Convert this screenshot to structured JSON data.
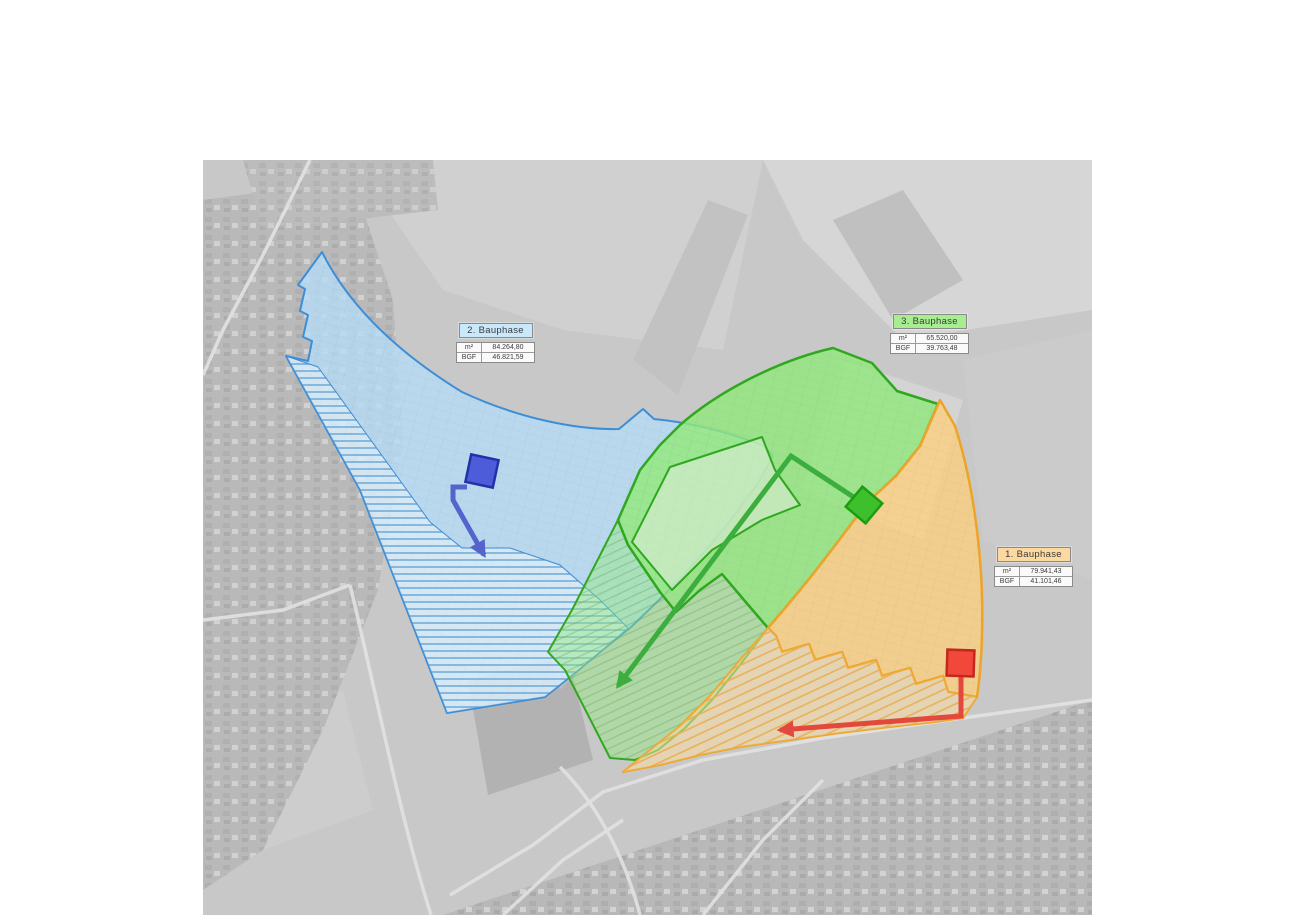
{
  "map": {
    "description": "Aerial construction phasing plan",
    "background_base": "#c8c8c8",
    "phases": [
      {
        "id": "phase-1",
        "label": "1. Bauphase",
        "table": {
          "rows": [
            {
              "label": "m²",
              "value": "79.941,43"
            },
            {
              "label": "BGF",
              "value": "41.101,46"
            }
          ]
        },
        "colors": {
          "fill": "#fbd07e",
          "border": "#eda429",
          "header_bg": "#fcd9a0",
          "hatch_line": "#e9ae54",
          "marker_fill": "#f2483b",
          "marker_border": "#c2281c",
          "arrow": "#e2483c"
        }
      },
      {
        "id": "phase-2",
        "label": "2. Bauphase",
        "table": {
          "rows": [
            {
              "label": "m²",
              "value": "84.264,80"
            },
            {
              "label": "BGF",
              "value": "46.821,59"
            }
          ]
        },
        "colors": {
          "fill": "#b5ddf7",
          "border": "#3e8ed6",
          "header_bg": "#c9e9fb",
          "hatch_line": "#5c9fd6",
          "marker_fill": "#4d5cd8",
          "marker_border": "#2232a6",
          "arrow": "#5563cd"
        }
      },
      {
        "id": "phase-3",
        "label": "3. Bauphase",
        "table": {
          "rows": [
            {
              "label": "m²",
              "value": "65.520,00"
            },
            {
              "label": "BGF",
              "value": "39.763,48"
            }
          ]
        },
        "colors": {
          "fill": "#93e87c",
          "border": "#2fa81f",
          "header_bg": "#a6ee90",
          "hatch_line": "#6fbf5e",
          "marker_fill": "#3ec02c",
          "marker_border": "#1d9d12",
          "arrow": "#3bae3e"
        }
      }
    ]
  }
}
